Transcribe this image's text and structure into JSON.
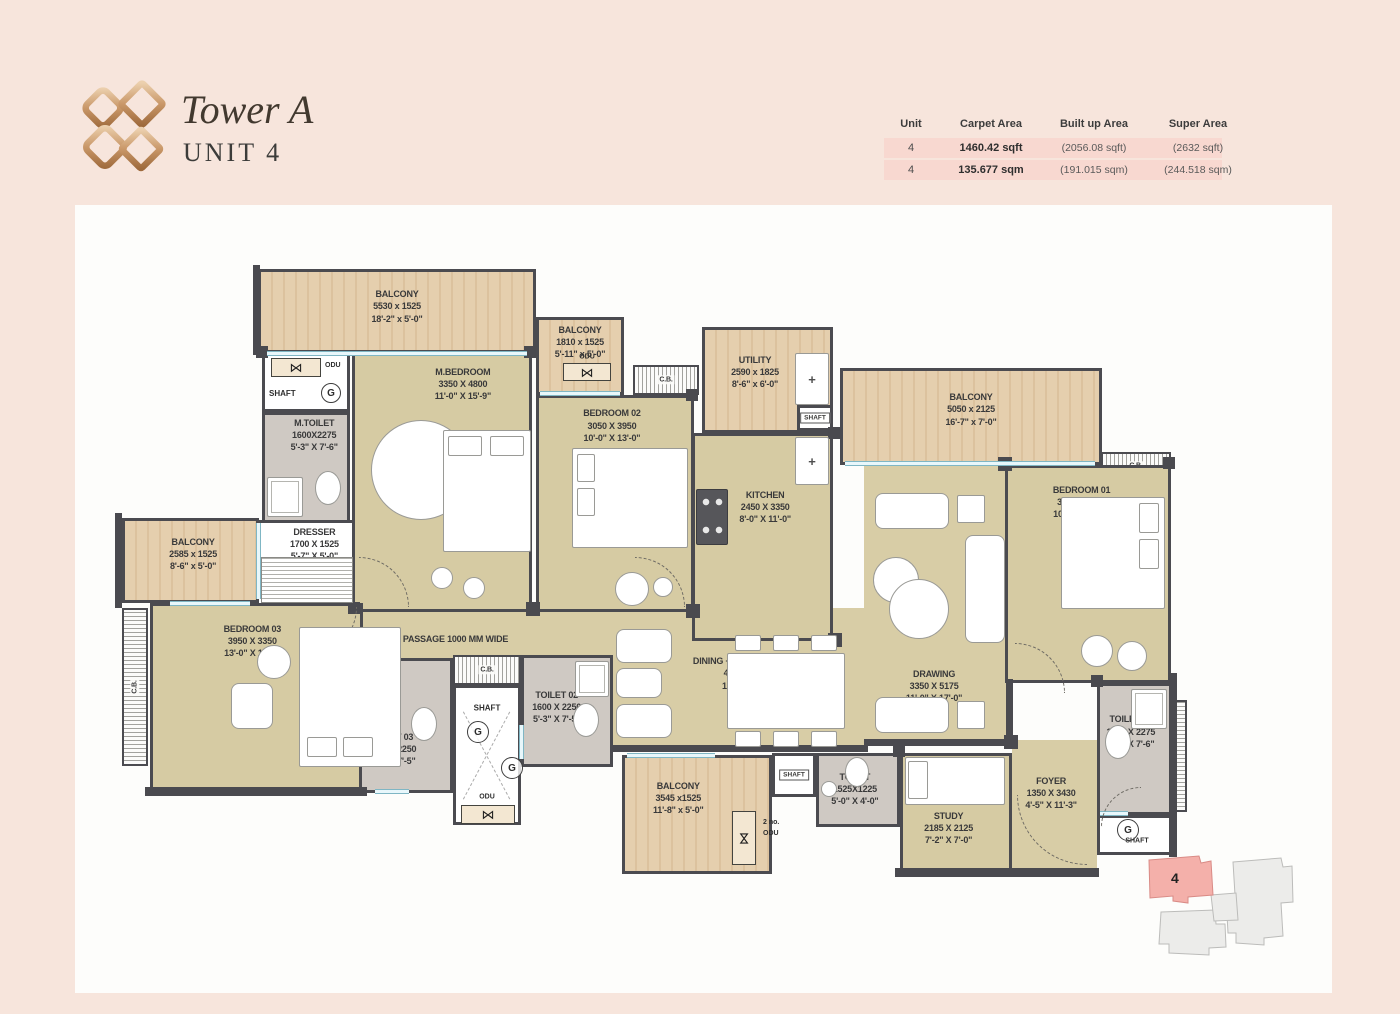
{
  "header": {
    "title": "Tower A",
    "subtitle": "UNIT 4",
    "logo_icon": "gold-diamonds-logo",
    "table": {
      "columns": [
        "Unit",
        "Carpet Area",
        "Built up Area",
        "Super Area"
      ],
      "rows": [
        {
          "unit": "4",
          "carpet": "1460.42 sqft",
          "built": "(2056.08 sqft)",
          "super": "(2632 sqft)"
        },
        {
          "unit": "4",
          "carpet": "135.677 sqm",
          "built": "(191.015 sqm)",
          "super": "(244.518 sqm)"
        }
      ]
    }
  },
  "colors": {
    "page_bg": "#f7e5dc",
    "row_stripe": "#f8d8d0",
    "accent_gold": "#b5814f",
    "wall": "#4a4a4f",
    "wood_floor": "#e0c8a6",
    "room_floor": "#d6cba3",
    "toilet_floor": "#cfc9c3",
    "window": "#aedfe9",
    "keyplan_highlight": "#f4b0aa"
  },
  "keyplan": {
    "unit": "4"
  },
  "plan": {
    "rooms": [
      {
        "id": "passage",
        "f": "openbeige",
        "x": 288,
        "y": 403,
        "w": 250,
        "h": 52,
        "lx": 37,
        "ly": 60,
        "fs": 9,
        "label": [
          "PASSAGE 1000 MM WIDE"
        ]
      },
      {
        "id": "lounge",
        "f": "openbeige",
        "x": 537,
        "y": 403,
        "w": 252,
        "h": 142,
        "lx": 54,
        "ly": 46,
        "label": [
          "DINING + FAMILY LOUNGE",
          "4315 X 2775",
          "14'-2\" X 9'-1\""
        ]
      },
      {
        "id": "drawing",
        "f": "openbeige",
        "x": 789,
        "y": 260,
        "w": 146,
        "h": 280,
        "lx": 48,
        "ly": 79,
        "label": [
          "DRAWING",
          "3350 X 5175",
          "11'-0\" X 17'-0\""
        ]
      },
      {
        "id": "foyer",
        "f": "openbeige",
        "x": 937,
        "y": 535,
        "w": 85,
        "h": 133,
        "lx": 46,
        "ly": 40,
        "label": [
          "FOYER",
          "1350 X 3430",
          "4'-5\" X 11'-3\""
        ]
      },
      {
        "id": "balcony-top-left",
        "f": "wood",
        "x": 183,
        "y": 64,
        "w": 278,
        "h": 84,
        "lx": 50,
        "ly": 44,
        "label": [
          "BALCONY",
          "5530 x 1525",
          "18'-2\" x 5'-0\""
        ]
      },
      {
        "id": "balcony-top-2",
        "f": "wood",
        "x": 461,
        "y": 112,
        "w": 88,
        "h": 78,
        "lx": 50,
        "ly": 30,
        "label": [
          "BALCONY",
          "1810 x 1525",
          "5'-11\" x 5'-0\""
        ]
      },
      {
        "id": "shaft-top-left",
        "f": "white",
        "x": 187,
        "y": 145,
        "w": 88,
        "h": 62
      },
      {
        "id": "m-toilet",
        "f": "gray",
        "x": 187,
        "y": 207,
        "w": 88,
        "h": 116,
        "lx": 60,
        "ly": 18,
        "label": [
          "M.TOILET",
          "1600X2275",
          "5'-3\" X 7'-6\""
        ]
      },
      {
        "id": "m-bedroom",
        "f": "beige",
        "x": 277,
        "y": 145,
        "w": 180,
        "h": 262,
        "lx": 62,
        "ly": 12,
        "label": [
          "M.BEDROOM",
          "3350 X 4800",
          "11'-0\" X 15'-9\""
        ]
      },
      {
        "id": "dresser",
        "f": "white",
        "x": 180,
        "y": 315,
        "w": 100,
        "h": 88,
        "lx": 60,
        "ly": 25,
        "label": [
          "DRESSER",
          "1700 X 1525",
          "5'-7\" X 5'-0\""
        ]
      },
      {
        "id": "bedroom-02",
        "f": "beige",
        "x": 461,
        "y": 190,
        "w": 158,
        "h": 217,
        "lx": 48,
        "ly": 13,
        "label": [
          "BEDROOM 02",
          "3050 X 3950",
          "10'-0\" X 13'-0\""
        ]
      },
      {
        "id": "cb-bedroom-02",
        "f": "hatchh",
        "x": 558,
        "y": 160,
        "w": 66,
        "h": 30,
        "fs": 7,
        "label": [
          "C.B."
        ]
      },
      {
        "id": "utility",
        "f": "wood",
        "x": 627,
        "y": 122,
        "w": 131,
        "h": 106,
        "lx": 40,
        "ly": 42,
        "label": [
          "UTILITY",
          "2590 x 1825",
          "8'-6\" x 6'-0\""
        ]
      },
      {
        "id": "shaft-utility",
        "f": "white",
        "x": 722,
        "y": 200,
        "w": 36,
        "h": 26
      },
      {
        "id": "kitchen",
        "f": "beige",
        "x": 617,
        "y": 228,
        "w": 141,
        "h": 208,
        "lx": 52,
        "ly": 35,
        "label": [
          "KITCHEN",
          "2450 X 3350",
          "8'-0\" X 11'-0\""
        ]
      },
      {
        "id": "balcony-right",
        "f": "wood",
        "x": 765,
        "y": 163,
        "w": 262,
        "h": 97,
        "lx": 50,
        "ly": 42,
        "label": [
          "BALCONY",
          "5050 x 2125",
          "16'-7\" x 7'-0\""
        ]
      },
      {
        "id": "cb-bedroom-01",
        "f": "hatchh",
        "x": 1026,
        "y": 247,
        "w": 70,
        "h": 28,
        "fs": 7,
        "label": [
          "C.B."
        ]
      },
      {
        "id": "bedroom-01",
        "f": "beige",
        "x": 930,
        "y": 260,
        "w": 166,
        "h": 218,
        "lx": 46,
        "ly": 16,
        "label": [
          "BEDROOM 01",
          "3050 X 3950",
          "10'-0\" X 13'-0\""
        ]
      },
      {
        "id": "balcony-left",
        "f": "wood",
        "x": 47,
        "y": 313,
        "w": 137,
        "h": 85,
        "lx": 52,
        "ly": 42,
        "label": [
          "BALCONY",
          "2585 x 1525",
          "8'-6\" x 5'-0\""
        ]
      },
      {
        "id": "cb-left",
        "f": "hatchv",
        "x": 47,
        "y": 403,
        "w": 26,
        "h": 158,
        "rot": true,
        "fs": 7,
        "label": [
          "C.B."
        ]
      },
      {
        "id": "bedroom-03",
        "f": "beige",
        "x": 75,
        "y": 398,
        "w": 213,
        "h": 190,
        "lx": 48,
        "ly": 19,
        "label": [
          "BEDROOM 03",
          "3950 X 3350",
          "13'-0\" X 11'-0\""
        ]
      },
      {
        "id": "toilet-03",
        "f": "gray",
        "x": 284,
        "y": 453,
        "w": 94,
        "h": 135,
        "lx": 34,
        "ly": 68,
        "label": [
          "TOILET 03",
          "1600 X 2250",
          "5'-3\" X 7'-5\""
        ]
      },
      {
        "id": "cb-center",
        "f": "hatchh",
        "x": 378,
        "y": 450,
        "w": 68,
        "h": 30,
        "fs": 7,
        "label": [
          "C.B."
        ]
      },
      {
        "id": "shaft-center",
        "f": "shaftx",
        "x": 378,
        "y": 480,
        "w": 68,
        "h": 140
      },
      {
        "id": "toilet-02",
        "f": "gray",
        "x": 446,
        "y": 450,
        "w": 92,
        "h": 112,
        "lx": 38,
        "ly": 46,
        "label": [
          "TOILET 02",
          "1600 X 2250",
          "5'-3\" X 7'-5\""
        ]
      },
      {
        "id": "balcony-bottom",
        "f": "wood",
        "x": 547,
        "y": 550,
        "w": 150,
        "h": 119,
        "lx": 37,
        "ly": 35,
        "label": [
          "BALCONY",
          "3545 x1525",
          "11'-8\" x 5'-0\""
        ]
      },
      {
        "id": "shaft-bottom-mid",
        "f": "white",
        "x": 697,
        "y": 548,
        "w": 44,
        "h": 44
      },
      {
        "id": "toilet-bottom",
        "f": "gray",
        "x": 741,
        "y": 548,
        "w": 84,
        "h": 74,
        "lx": 46,
        "ly": 48,
        "label": [
          "TOILET",
          "1525X1225",
          "5'-0\" X 4'-0\""
        ]
      },
      {
        "id": "study",
        "f": "beige",
        "x": 825,
        "y": 548,
        "w": 112,
        "h": 122,
        "lx": 43,
        "ly": 62,
        "label": [
          "STUDY",
          "2185 X 2125",
          "7'-2\" X 7'-0\""
        ]
      },
      {
        "id": "toilet-01",
        "f": "gray",
        "x": 1022,
        "y": 478,
        "w": 76,
        "h": 132,
        "lx": 44,
        "ly": 36,
        "label": [
          "TOILET 01",
          "1600 X 2275",
          "5'-3\" X 7'-6\""
        ]
      },
      {
        "id": "shaft-bottom-right",
        "f": "white",
        "x": 1022,
        "y": 610,
        "w": 76,
        "h": 40
      },
      {
        "id": "ledge-right",
        "f": "hatchv",
        "x": 1100,
        "y": 495,
        "w": 12,
        "h": 112
      }
    ],
    "annotations": [
      {
        "t": "odu",
        "x": 196,
        "y": 153,
        "w": 50,
        "h": 19
      },
      {
        "t": "txt",
        "s": "ODU",
        "x": 250,
        "y": 157
      },
      {
        "t": "txt",
        "s": "SHAFT",
        "x": 194,
        "y": 184,
        "fs": 8
      },
      {
        "t": "g",
        "x": 246,
        "y": 178,
        "d": 20
      },
      {
        "t": "txtc",
        "s": "ODU",
        "x": 512,
        "y": 152
      },
      {
        "t": "odu",
        "x": 488,
        "y": 158,
        "w": 48,
        "h": 18
      },
      {
        "t": "tag",
        "s": "SHAFT",
        "x": 740,
        "y": 213
      },
      {
        "t": "txtc",
        "s": "SHAFT",
        "x": 412,
        "y": 503,
        "fs": 8
      },
      {
        "t": "g",
        "x": 392,
        "y": 516,
        "d": 22
      },
      {
        "t": "g",
        "x": 426,
        "y": 552,
        "d": 22
      },
      {
        "t": "txtc",
        "s": "ODU",
        "x": 412,
        "y": 592
      },
      {
        "t": "odu",
        "x": 386,
        "y": 600,
        "w": 54,
        "h": 19
      },
      {
        "t": "tag",
        "s": "SHAFT",
        "x": 719,
        "y": 570
      },
      {
        "t": "oduv",
        "x": 657,
        "y": 606,
        "w": 24,
        "h": 54
      },
      {
        "t": "txt",
        "s": "2 no.",
        "x": 688,
        "y": 614
      },
      {
        "t": "txt",
        "s": "ODU",
        "x": 688,
        "y": 625
      },
      {
        "t": "g",
        "x": 1042,
        "y": 614,
        "d": 22
      },
      {
        "t": "txtc",
        "s": "SHAFT",
        "x": 1062,
        "y": 636
      }
    ],
    "walls": [
      {
        "x": 70,
        "y": 582,
        "w": 222,
        "h": 9
      },
      {
        "x": 537,
        "y": 540,
        "w": 256,
        "h": 7
      },
      {
        "x": 820,
        "y": 663,
        "w": 204,
        "h": 9
      },
      {
        "x": 1094,
        "y": 468,
        "w": 8,
        "h": 184
      },
      {
        "x": 40,
        "y": 308,
        "w": 7,
        "h": 95
      },
      {
        "x": 178,
        "y": 60,
        "w": 7,
        "h": 90
      },
      {
        "x": 789,
        "y": 534,
        "w": 150,
        "h": 7
      },
      {
        "x": 931,
        "y": 474,
        "w": 7,
        "h": 64
      }
    ],
    "pillars": [
      {
        "x": 181,
        "y": 141,
        "s": 12
      },
      {
        "x": 449,
        "y": 141,
        "s": 12
      },
      {
        "x": 451,
        "y": 397,
        "s": 14
      },
      {
        "x": 273,
        "y": 397,
        "s": 12
      },
      {
        "x": 611,
        "y": 184,
        "s": 12
      },
      {
        "x": 611,
        "y": 399,
        "s": 14
      },
      {
        "x": 753,
        "y": 222,
        "s": 12
      },
      {
        "x": 753,
        "y": 428,
        "s": 14
      },
      {
        "x": 923,
        "y": 252,
        "s": 14
      },
      {
        "x": 1088,
        "y": 252,
        "s": 12
      },
      {
        "x": 929,
        "y": 530,
        "s": 14
      },
      {
        "x": 818,
        "y": 540,
        "s": 12
      },
      {
        "x": 280,
        "y": 446,
        "s": 12
      },
      {
        "x": 1016,
        "y": 470,
        "s": 12
      }
    ],
    "windows": [
      {
        "x": 192,
        "y": 146,
        "w": 260,
        "h": 5
      },
      {
        "x": 465,
        "y": 186,
        "w": 80,
        "h": 5
      },
      {
        "x": 770,
        "y": 256,
        "w": 250,
        "h": 5
      },
      {
        "x": 181,
        "y": 318,
        "w": 5,
        "h": 76
      },
      {
        "x": 95,
        "y": 396,
        "w": 80,
        "h": 5
      },
      {
        "x": 552,
        "y": 548,
        "w": 88,
        "h": 5
      },
      {
        "x": 300,
        "y": 584,
        "w": 34,
        "h": 5
      },
      {
        "x": 444,
        "y": 520,
        "w": 5,
        "h": 34
      },
      {
        "x": 1025,
        "y": 606,
        "w": 28,
        "h": 5
      }
    ],
    "furniture": [
      {
        "c": "circ",
        "x": 296,
        "y": 215,
        "w": 100,
        "h": 100
      },
      {
        "c": "rect",
        "x": 368,
        "y": 225,
        "w": 88,
        "h": 122
      },
      {
        "c": "rect",
        "x": 373,
        "y": 231,
        "w": 34,
        "h": 20
      },
      {
        "c": "rect",
        "x": 415,
        "y": 231,
        "w": 34,
        "h": 20
      },
      {
        "c": "circ",
        "x": 356,
        "y": 362,
        "w": 22,
        "h": 22
      },
      {
        "c": "circ",
        "x": 388,
        "y": 372,
        "w": 22,
        "h": 22
      },
      {
        "c": "rect",
        "x": 497,
        "y": 243,
        "w": 116,
        "h": 100
      },
      {
        "c": "rect",
        "x": 502,
        "y": 249,
        "w": 18,
        "h": 28
      },
      {
        "c": "rect",
        "x": 502,
        "y": 283,
        "w": 18,
        "h": 28
      },
      {
        "c": "circ",
        "x": 540,
        "y": 367,
        "w": 34,
        "h": 34
      },
      {
        "c": "circ",
        "x": 578,
        "y": 372,
        "w": 20,
        "h": 20
      },
      {
        "c": "rect",
        "x": 986,
        "y": 292,
        "w": 104,
        "h": 112
      },
      {
        "c": "rect",
        "x": 1064,
        "y": 298,
        "w": 20,
        "h": 30
      },
      {
        "c": "rect",
        "x": 1064,
        "y": 334,
        "w": 20,
        "h": 30
      },
      {
        "c": "circ",
        "x": 1006,
        "y": 430,
        "w": 32,
        "h": 32
      },
      {
        "c": "circ",
        "x": 1042,
        "y": 436,
        "w": 30,
        "h": 30
      },
      {
        "c": "rect",
        "x": 224,
        "y": 422,
        "w": 102,
        "h": 140
      },
      {
        "c": "rect",
        "x": 232,
        "y": 532,
        "w": 30,
        "h": 20
      },
      {
        "c": "rect",
        "x": 268,
        "y": 532,
        "w": 30,
        "h": 20
      },
      {
        "c": "circ",
        "x": 182,
        "y": 440,
        "w": 34,
        "h": 34
      },
      {
        "c": "sofa",
        "x": 156,
        "y": 478,
        "w": 42,
        "h": 46
      },
      {
        "c": "rect",
        "x": 830,
        "y": 552,
        "w": 100,
        "h": 48
      },
      {
        "c": "rect",
        "x": 833,
        "y": 556,
        "w": 20,
        "h": 38
      },
      {
        "c": "rect",
        "x": 652,
        "y": 448,
        "w": 118,
        "h": 76
      },
      {
        "c": "rect",
        "x": 660,
        "y": 430,
        "w": 26,
        "h": 16
      },
      {
        "c": "rect",
        "x": 698,
        "y": 430,
        "w": 26,
        "h": 16
      },
      {
        "c": "rect",
        "x": 736,
        "y": 430,
        "w": 26,
        "h": 16
      },
      {
        "c": "rect",
        "x": 660,
        "y": 526,
        "w": 26,
        "h": 16
      },
      {
        "c": "rect",
        "x": 698,
        "y": 526,
        "w": 26,
        "h": 16
      },
      {
        "c": "rect",
        "x": 736,
        "y": 526,
        "w": 26,
        "h": 16
      },
      {
        "c": "sofa",
        "x": 541,
        "y": 424,
        "w": 56,
        "h": 34
      },
      {
        "c": "sofa",
        "x": 541,
        "y": 463,
        "w": 46,
        "h": 30
      },
      {
        "c": "sofa",
        "x": 541,
        "y": 499,
        "w": 56,
        "h": 34
      },
      {
        "c": "sofa",
        "x": 800,
        "y": 288,
        "w": 74,
        "h": 36
      },
      {
        "c": "rect",
        "x": 882,
        "y": 290,
        "w": 28,
        "h": 28
      },
      {
        "c": "sofa",
        "x": 890,
        "y": 330,
        "w": 40,
        "h": 108
      },
      {
        "c": "circ",
        "x": 798,
        "y": 352,
        "w": 46,
        "h": 46
      },
      {
        "c": "circ",
        "x": 814,
        "y": 374,
        "w": 60,
        "h": 60
      },
      {
        "c": "sofa",
        "x": 800,
        "y": 492,
        "w": 74,
        "h": 36
      },
      {
        "c": "rect",
        "x": 882,
        "y": 496,
        "w": 28,
        "h": 28
      },
      {
        "c": "stove",
        "x": 621,
        "y": 284,
        "w": 32,
        "h": 56
      },
      {
        "c": "plus",
        "x": 720,
        "y": 232,
        "w": 34,
        "h": 48
      },
      {
        "c": "plus",
        "x": 720,
        "y": 148,
        "w": 34,
        "h": 52
      },
      {
        "c": "ell",
        "x": 240,
        "y": 266,
        "w": 26,
        "h": 34
      },
      {
        "c": "shower",
        "x": 192,
        "y": 272,
        "w": 36,
        "h": 40
      },
      {
        "c": "ell",
        "x": 336,
        "y": 502,
        "w": 26,
        "h": 34
      },
      {
        "c": "shower",
        "x": 500,
        "y": 456,
        "w": 34,
        "h": 36
      },
      {
        "c": "ell",
        "x": 498,
        "y": 498,
        "w": 26,
        "h": 34
      },
      {
        "c": "ell",
        "x": 770,
        "y": 552,
        "w": 24,
        "h": 30
      },
      {
        "c": "circ",
        "x": 746,
        "y": 576,
        "w": 16,
        "h": 16
      },
      {
        "c": "shower",
        "x": 1056,
        "y": 484,
        "w": 36,
        "h": 40
      },
      {
        "c": "ell",
        "x": 1030,
        "y": 520,
        "w": 26,
        "h": 34
      },
      {
        "c": "hatch",
        "x": 186,
        "y": 352,
        "w": 92,
        "h": 46
      }
    ],
    "doors": [
      {
        "x": 284,
        "y": 352,
        "s": 50,
        "r": 90
      },
      {
        "x": 560,
        "y": 352,
        "s": 50,
        "r": 90
      },
      {
        "x": 232,
        "y": 402,
        "s": 50,
        "r": 180
      },
      {
        "x": 940,
        "y": 438,
        "s": 50,
        "r": 90
      },
      {
        "x": 942,
        "y": 590,
        "s": 70,
        "r": 270
      },
      {
        "x": 1026,
        "y": 582,
        "s": 40,
        "r": 0
      }
    ]
  }
}
